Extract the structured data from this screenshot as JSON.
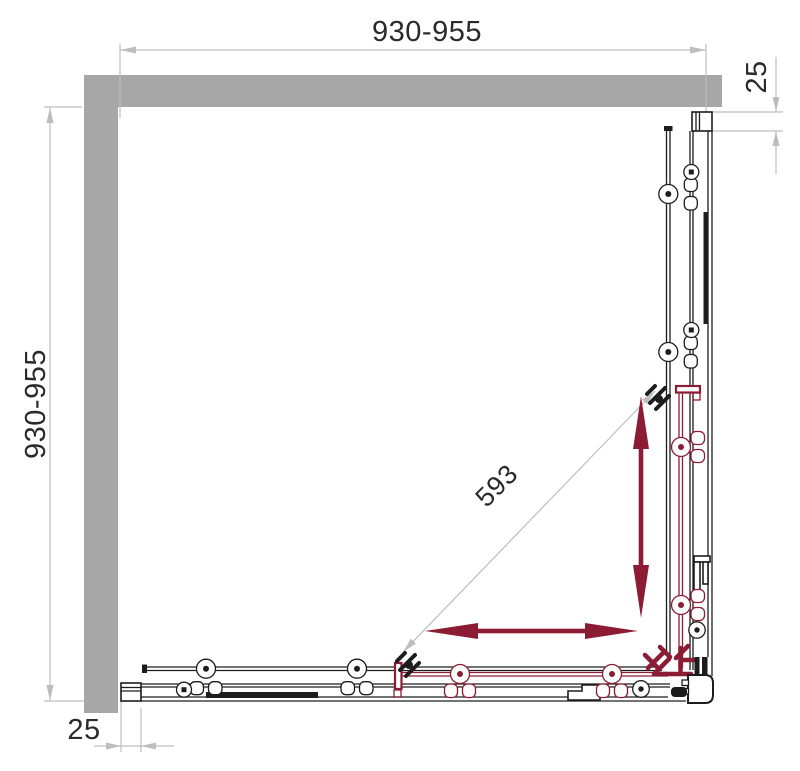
{
  "drawing": {
    "title": "Corner shower enclosure - top view technical diagram",
    "dimensions": {
      "top_width": "930-955",
      "left_height": "930-955",
      "right_offset": "25",
      "bottom_offset": "25",
      "diagonal_opening": "593"
    },
    "icons": {
      "vertical_slide_arrow": "double-headed-arrow-vertical",
      "horizontal_slide_arrow": "double-headed-arrow-horizontal"
    },
    "colors": {
      "wall": "#a7a7a7",
      "dim_line": "#bdbdbd",
      "ink": "#1d1d1d",
      "accent": "#8c1c34",
      "background": "#ffffff"
    }
  }
}
